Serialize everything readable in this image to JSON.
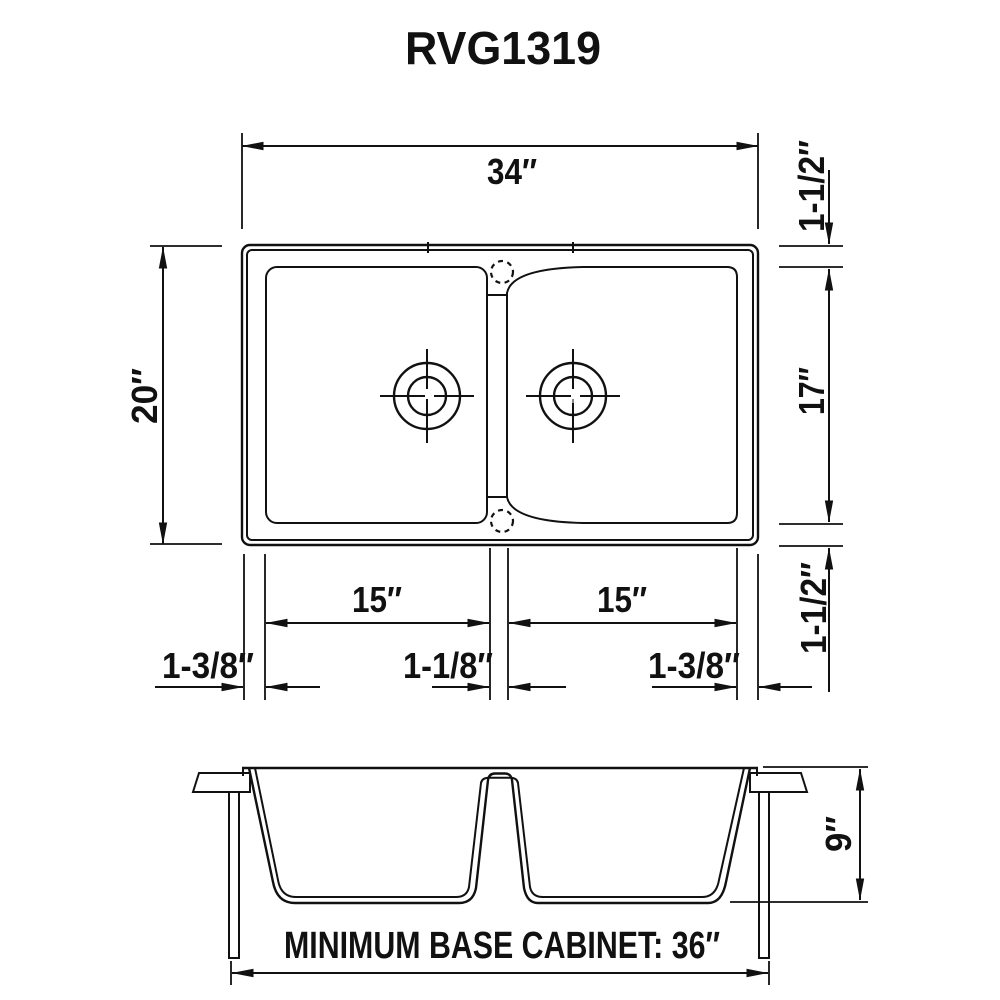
{
  "title": "RVG1319",
  "colors": {
    "ink": "#111111",
    "background": "#ffffff"
  },
  "top_view": {
    "overall_width": "34″",
    "overall_depth": "20″",
    "top_rim": "1-1/2″",
    "inner_depth": "17″",
    "bottom_rim": "1-1/2″",
    "left_bowl_width": "15″",
    "right_bowl_width": "15″",
    "left_rim": "1-3/8″",
    "center_rim": "1-1/8″",
    "right_rim": "1-3/8″"
  },
  "front_view": {
    "bowl_depth": "9″",
    "cabinet_note": "MINIMUM BASE CABINET: 36″"
  }
}
